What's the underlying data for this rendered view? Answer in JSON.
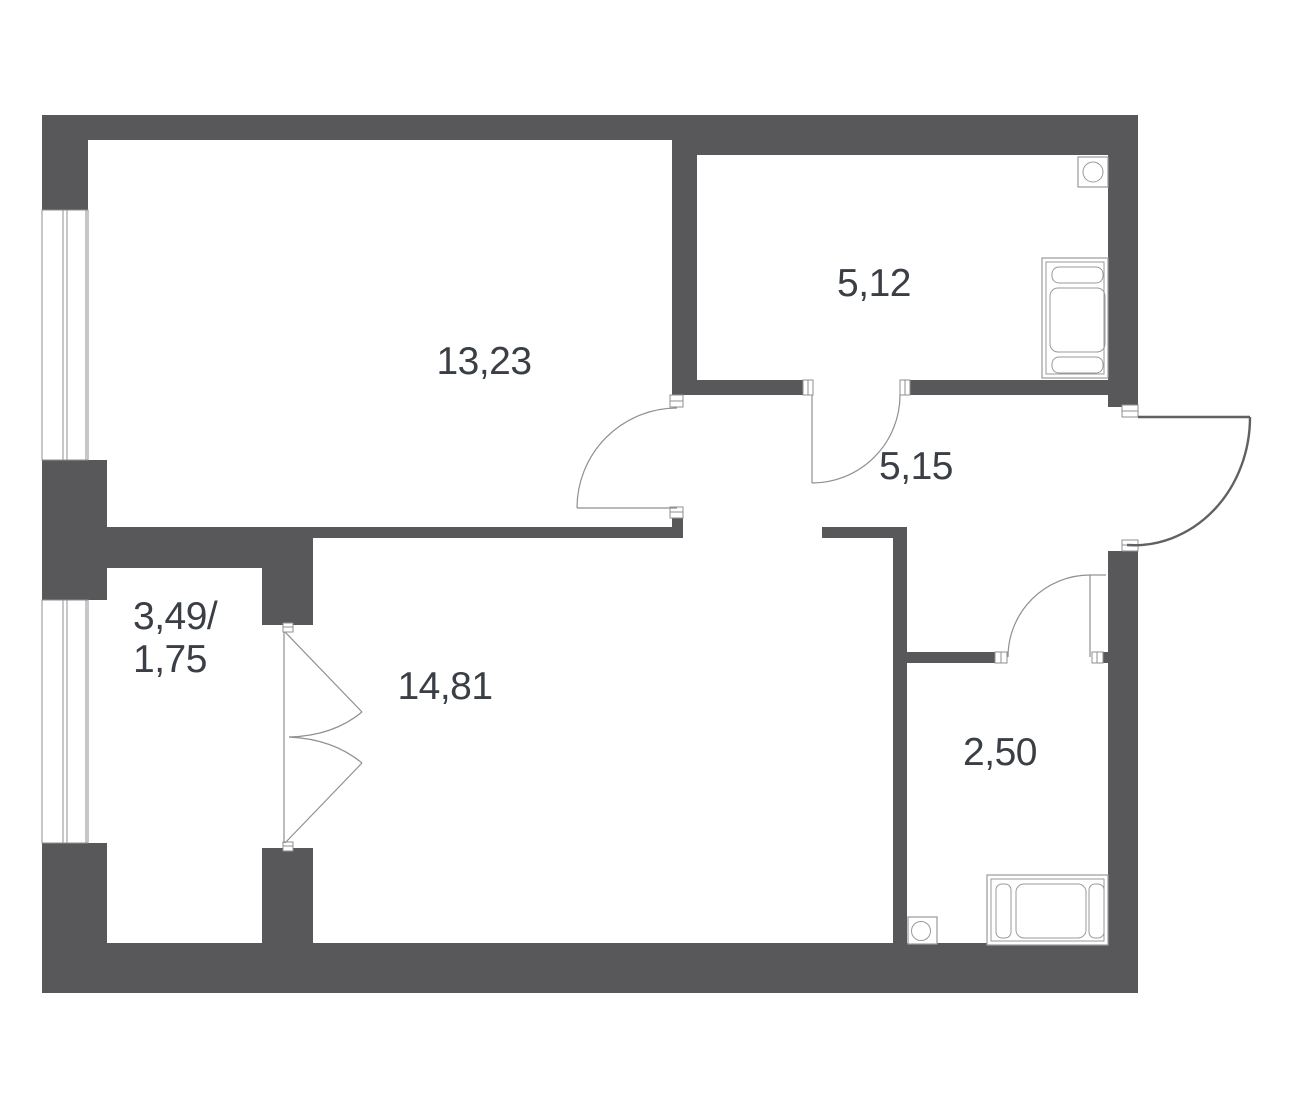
{
  "title": "Apartment floor plan",
  "colors": {
    "background": "#FFFFFF",
    "wall": "#58585A",
    "text": "#3A3E45",
    "line": "#8F8F8F",
    "fixture": "#9A9A9A"
  },
  "rooms": [
    {
      "name": "room-top-left",
      "label": "13,23"
    },
    {
      "name": "room-top-right",
      "label": "5,12"
    },
    {
      "name": "hallway",
      "label": "5,15"
    },
    {
      "name": "room-bottom-large",
      "label": "14,81"
    },
    {
      "name": "room-bottom-right",
      "label": "2,50"
    },
    {
      "name": "balcony",
      "label_line1": "3,49/",
      "label_line2": "1,75"
    }
  ],
  "fixtures": [
    {
      "name": "washer-icon",
      "room": "5,12",
      "shape": "square-with-circle"
    },
    {
      "name": "bathtub-icon",
      "room": "5,12",
      "shape": "rect-with-pads"
    },
    {
      "name": "toilet-icon",
      "room": "2,50",
      "shape": "square-with-circle"
    },
    {
      "name": "bathtub-icon",
      "room": "2,50",
      "shape": "rect-with-pads"
    }
  ],
  "doors": [
    {
      "name": "door-room-13-23",
      "type": "single-swing"
    },
    {
      "name": "door-room-5-12",
      "type": "single-swing"
    },
    {
      "name": "door-room-2-50",
      "type": "single-swing"
    },
    {
      "name": "entrance-door",
      "type": "single-swing-heavy"
    },
    {
      "name": "balcony-door",
      "type": "double-swing"
    }
  ],
  "windows": [
    {
      "name": "window-room-13-23"
    },
    {
      "name": "window-balcony"
    }
  ]
}
